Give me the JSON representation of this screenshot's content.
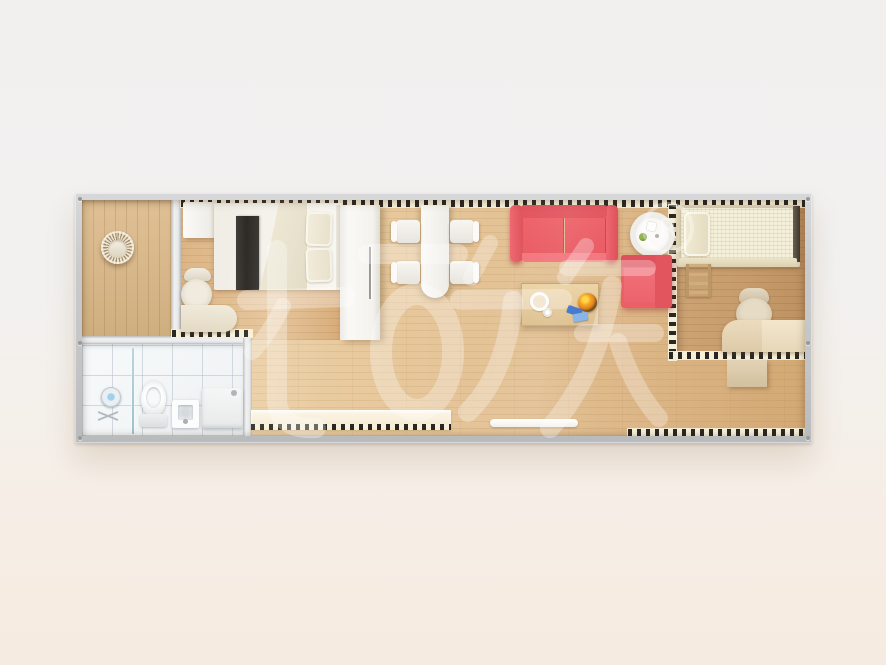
{
  "scene": {
    "description": "Top-down 3D rendering of a single-container tiny-house floor plan",
    "watermark": {
      "text": "柜族",
      "registered": "R"
    }
  },
  "palette": {
    "bg-top": "#f1f0ef",
    "bg-warm": "#f7ece2",
    "frame-gray": "#c8cacb",
    "dash-ink": "#2a2722",
    "dash-paper": "#f7f0d8",
    "sofa-red": "#ed5f67",
    "sofa-red-dark": "#dd4f59",
    "bed-runner": "#24211d",
    "living-wood": "#e2c093",
    "bedroom2-wood": "#c79c6c",
    "porch-wood": "#d7b78a",
    "bathroom-tile": "#f3f6f7",
    "bench-cream": "#f7efd9",
    "watermark-white": "rgba(255,255,255,0.30)"
  },
  "rooms": [
    {
      "name": "porch"
    },
    {
      "name": "bathroom"
    },
    {
      "name": "bedroom-1"
    },
    {
      "name": "living-dining"
    },
    {
      "name": "bedroom-2"
    }
  ],
  "furniture": [
    "hanging-chair",
    "shower",
    "glass-divider",
    "toilet",
    "wash-basin",
    "vanity-cabinet",
    "bedside-cabinet",
    "double-bed",
    "office-chair",
    "desk",
    "wardrobe",
    "dining-table",
    "dining-chair-x4",
    "sofa",
    "side-table",
    "armchair",
    "coffee-table",
    "storage-bench",
    "door-mat",
    "single-bed",
    "loft-ladder",
    "office-chair-2",
    "desk-2",
    "low-cabinet"
  ]
}
